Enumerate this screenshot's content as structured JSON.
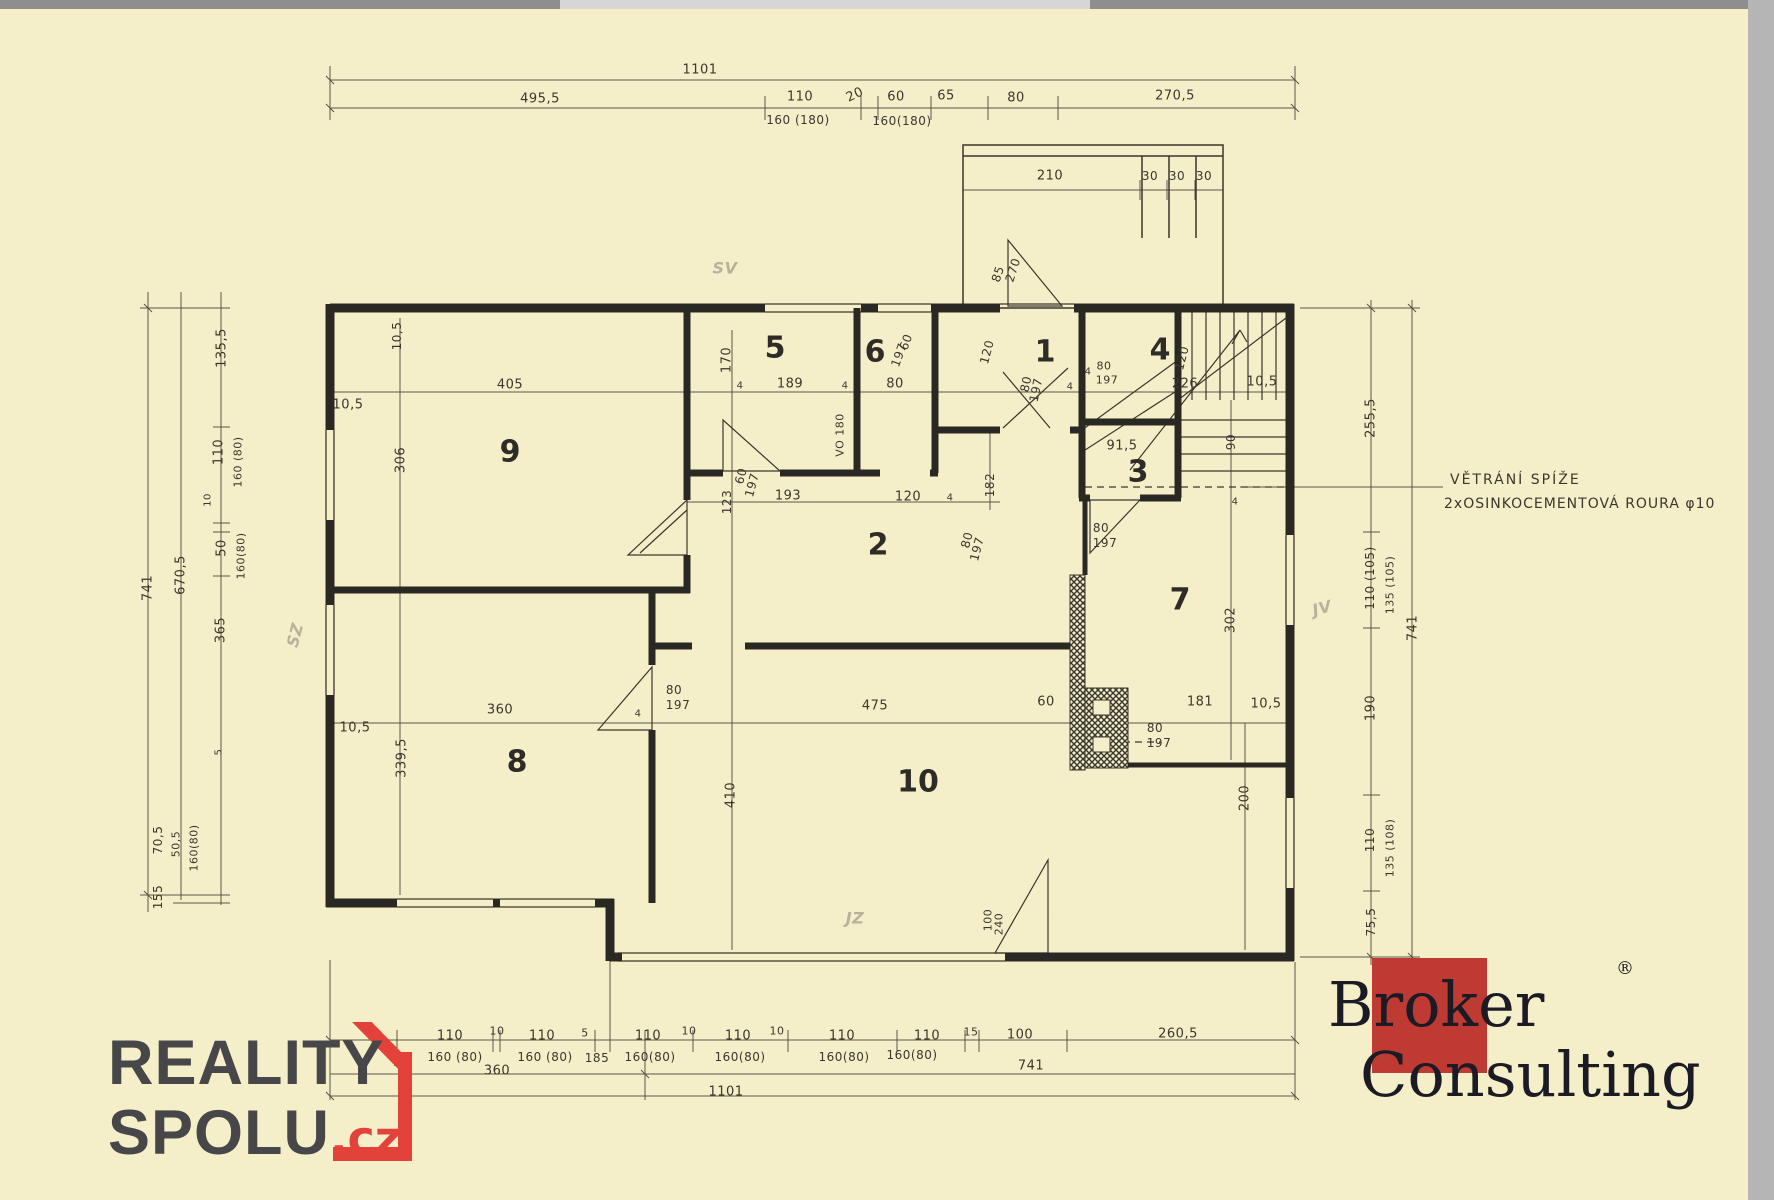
{
  "colors": {
    "paper": "#f5efc9",
    "ink": "#3a372e",
    "wall": "#2a2823",
    "pencil": "#aaa393",
    "reality_red": "#e2423a",
    "reality_grey": "#47474a",
    "broker_red": "#bf3a33",
    "broker_text": "#1b1b25"
  },
  "annotation": {
    "line1": "VĚTRÁNÍ SPÍŽE",
    "line2": "2xOSINKOCEMENTOVÁ ROURA φ10"
  },
  "logos": {
    "reality": {
      "line1": "REALITY",
      "line2": "SPOLU",
      "tld": ".cz"
    },
    "broker": {
      "word1": "Broker",
      "word2": "Consulting",
      "reg": "®"
    }
  },
  "rooms": [
    {
      "n": "1",
      "x": 1045,
      "y": 352
    },
    {
      "n": "2",
      "x": 878,
      "y": 545
    },
    {
      "n": "3",
      "x": 1138,
      "y": 472
    },
    {
      "n": "4",
      "x": 1160,
      "y": 350
    },
    {
      "n": "5",
      "x": 775,
      "y": 348
    },
    {
      "n": "6",
      "x": 875,
      "y": 352
    },
    {
      "n": "7",
      "x": 1180,
      "y": 600
    },
    {
      "n": "8",
      "x": 517,
      "y": 762
    },
    {
      "n": "9",
      "x": 510,
      "y": 452
    },
    {
      "n": "10",
      "x": 918,
      "y": 782
    }
  ],
  "labels": [
    {
      "t": "1101",
      "x": 700,
      "y": 70
    },
    {
      "t": "495,5",
      "x": 540,
      "y": 99
    },
    {
      "t": "110",
      "x": 800,
      "y": 97
    },
    {
      "t": "160 (180)",
      "x": 798,
      "y": 120,
      "s": 12
    },
    {
      "t": "20",
      "x": 855,
      "y": 95,
      "r": -25
    },
    {
      "t": "60",
      "x": 896,
      "y": 97
    },
    {
      "t": "160(180)",
      "x": 902,
      "y": 121,
      "s": 12
    },
    {
      "t": "65",
      "x": 946,
      "y": 96
    },
    {
      "t": "80",
      "x": 1016,
      "y": 98
    },
    {
      "t": "270,5",
      "x": 1175,
      "y": 96
    },
    {
      "t": "210",
      "x": 1050,
      "y": 176
    },
    {
      "t": "30",
      "x": 1150,
      "y": 176,
      "s": 12
    },
    {
      "t": "30",
      "x": 1177,
      "y": 176,
      "s": 12
    },
    {
      "t": "30",
      "x": 1204,
      "y": 176,
      "s": 12
    },
    {
      "t": "SV",
      "x": 725,
      "y": 268,
      "s": 16,
      "c": "pencil"
    },
    {
      "t": "SZ",
      "x": 295,
      "y": 635,
      "r": -75,
      "s": 16,
      "c": "pencil"
    },
    {
      "t": "JV",
      "x": 1322,
      "y": 608,
      "r": -15,
      "s": 16,
      "c": "pencil"
    },
    {
      "t": "JZ",
      "x": 855,
      "y": 918,
      "s": 16,
      "c": "pencil"
    },
    {
      "t": "85",
      "x": 998,
      "y": 274,
      "r": -72,
      "s": 12
    },
    {
      "t": "270",
      "x": 1013,
      "y": 270,
      "r": -72,
      "s": 12
    },
    {
      "t": "405",
      "x": 510,
      "y": 385
    },
    {
      "t": "10,5",
      "x": 348,
      "y": 405
    },
    {
      "t": "10,5",
      "x": 397,
      "y": 336,
      "r": -90,
      "s": 12
    },
    {
      "t": "306",
      "x": 401,
      "y": 460,
      "r": -90
    },
    {
      "t": "4",
      "x": 740,
      "y": 386,
      "s": 10
    },
    {
      "t": "189",
      "x": 790,
      "y": 384
    },
    {
      "t": "80",
      "x": 895,
      "y": 384
    },
    {
      "t": "4",
      "x": 845,
      "y": 386,
      "s": 10
    },
    {
      "t": "120",
      "x": 987,
      "y": 352,
      "r": -75,
      "s": 12
    },
    {
      "t": "80",
      "x": 1026,
      "y": 384,
      "r": -78,
      "s": 12
    },
    {
      "t": "197",
      "x": 1036,
      "y": 390,
      "r": -78,
      "s": 12
    },
    {
      "t": "4",
      "x": 1070,
      "y": 387,
      "s": 10
    },
    {
      "t": "4",
      "x": 1088,
      "y": 372,
      "s": 10
    },
    {
      "t": "80",
      "x": 1104,
      "y": 366,
      "s": 11
    },
    {
      "t": "197",
      "x": 1107,
      "y": 380,
      "s": 11
    },
    {
      "t": "226",
      "x": 1185,
      "y": 384
    },
    {
      "t": "10,5",
      "x": 1262,
      "y": 382
    },
    {
      "t": "120",
      "x": 1182,
      "y": 358,
      "r": -75,
      "s": 12
    },
    {
      "t": "170",
      "x": 727,
      "y": 360,
      "r": -90
    },
    {
      "t": "60",
      "x": 906,
      "y": 342,
      "r": -70,
      "s": 12
    },
    {
      "t": "197",
      "x": 899,
      "y": 355,
      "r": -70,
      "s": 12
    },
    {
      "t": "VO 180",
      "x": 840,
      "y": 435,
      "r": -90,
      "s": 11
    },
    {
      "t": "135,5",
      "x": 222,
      "y": 348,
      "r": -90
    },
    {
      "t": "110",
      "x": 219,
      "y": 452,
      "r": -90
    },
    {
      "t": "160 (80)",
      "x": 238,
      "y": 462,
      "r": -90,
      "s": 11
    },
    {
      "t": "10",
      "x": 208,
      "y": 500,
      "r": -90,
      "s": 10
    },
    {
      "t": "50",
      "x": 222,
      "y": 548,
      "r": -90
    },
    {
      "t": "160(80)",
      "x": 241,
      "y": 556,
      "r": -90,
      "s": 11
    },
    {
      "t": "670,5",
      "x": 181,
      "y": 575,
      "r": -90
    },
    {
      "t": "741",
      "x": 148,
      "y": 588,
      "r": -90
    },
    {
      "t": "365",
      "x": 221,
      "y": 630,
      "r": -90
    },
    {
      "t": "5",
      "x": 219,
      "y": 752,
      "r": -90,
      "s": 10
    },
    {
      "t": "70,5",
      "x": 158,
      "y": 840,
      "r": -90,
      "s": 12
    },
    {
      "t": "50,5",
      "x": 176,
      "y": 844,
      "r": -90,
      "s": 11
    },
    {
      "t": "160(80)",
      "x": 194,
      "y": 848,
      "r": -90,
      "s": 11
    },
    {
      "t": "155",
      "x": 158,
      "y": 897,
      "r": -90,
      "s": 12
    },
    {
      "t": "123",
      "x": 727,
      "y": 502,
      "r": -90,
      "s": 12
    },
    {
      "t": "60",
      "x": 741,
      "y": 476,
      "r": -75,
      "s": 12
    },
    {
      "t": "197",
      "x": 752,
      "y": 485,
      "r": -75,
      "s": 12
    },
    {
      "t": "193",
      "x": 788,
      "y": 496
    },
    {
      "t": "120",
      "x": 908,
      "y": 497
    },
    {
      "t": "4",
      "x": 950,
      "y": 498,
      "s": 10
    },
    {
      "t": "182",
      "x": 990,
      "y": 485,
      "r": -90,
      "s": 12
    },
    {
      "t": "80",
      "x": 967,
      "y": 540,
      "r": -75,
      "s": 12
    },
    {
      "t": "197",
      "x": 977,
      "y": 549,
      "r": -75,
      "s": 12
    },
    {
      "t": "91,5",
      "x": 1122,
      "y": 446
    },
    {
      "t": "90",
      "x": 1231,
      "y": 442,
      "r": -90,
      "s": 12
    },
    {
      "t": "4",
      "x": 1235,
      "y": 502,
      "s": 10
    },
    {
      "t": "80",
      "x": 1101,
      "y": 528,
      "s": 12
    },
    {
      "t": "197",
      "x": 1105,
      "y": 543,
      "s": 12
    },
    {
      "t": "10,5",
      "x": 355,
      "y": 728
    },
    {
      "t": "360",
      "x": 500,
      "y": 710
    },
    {
      "t": "339,5",
      "x": 402,
      "y": 758,
      "r": -90
    },
    {
      "t": "4",
      "x": 638,
      "y": 714,
      "s": 10
    },
    {
      "t": "80",
      "x": 674,
      "y": 690,
      "s": 12
    },
    {
      "t": "197",
      "x": 678,
      "y": 705,
      "s": 12
    },
    {
      "t": "475",
      "x": 875,
      "y": 706
    },
    {
      "t": "60",
      "x": 1046,
      "y": 702
    },
    {
      "t": "181",
      "x": 1200,
      "y": 702
    },
    {
      "t": "10,5",
      "x": 1266,
      "y": 704
    },
    {
      "t": "80",
      "x": 1155,
      "y": 728,
      "s": 12
    },
    {
      "t": "197",
      "x": 1159,
      "y": 743,
      "s": 12
    },
    {
      "t": "302",
      "x": 1231,
      "y": 620,
      "r": -90
    },
    {
      "t": "200",
      "x": 1245,
      "y": 798,
      "r": -90
    },
    {
      "t": "410",
      "x": 731,
      "y": 795,
      "r": -90
    },
    {
      "t": "100",
      "x": 988,
      "y": 920,
      "r": -90,
      "s": 11
    },
    {
      "t": "240",
      "x": 999,
      "y": 924,
      "r": -90,
      "s": 11
    },
    {
      "t": "255,5",
      "x": 1371,
      "y": 418,
      "r": -90
    },
    {
      "t": "110 (105)",
      "x": 1370,
      "y": 578,
      "r": -90,
      "s": 12
    },
    {
      "t": "135 (105)",
      "x": 1390,
      "y": 585,
      "r": -90,
      "s": 11
    },
    {
      "t": "190",
      "x": 1371,
      "y": 708,
      "r": -90
    },
    {
      "t": "110",
      "x": 1370,
      "y": 840,
      "r": -90,
      "s": 12
    },
    {
      "t": "135 (108)",
      "x": 1390,
      "y": 848,
      "r": -90,
      "s": 11
    },
    {
      "t": "75,5",
      "x": 1371,
      "y": 922,
      "r": -90,
      "s": 12
    },
    {
      "t": "741",
      "x": 1413,
      "y": 628,
      "r": -90
    },
    {
      "t": "110",
      "x": 450,
      "y": 1036
    },
    {
      "t": "160 (80)",
      "x": 455,
      "y": 1057,
      "s": 12
    },
    {
      "t": "10",
      "x": 497,
      "y": 1031,
      "s": 11
    },
    {
      "t": "110",
      "x": 542,
      "y": 1036
    },
    {
      "t": "160 (80)",
      "x": 545,
      "y": 1057,
      "s": 12
    },
    {
      "t": "5",
      "x": 585,
      "y": 1033,
      "s": 11
    },
    {
      "t": "185",
      "x": 597,
      "y": 1058,
      "s": 12
    },
    {
      "t": "110",
      "x": 648,
      "y": 1036
    },
    {
      "t": "160(80)",
      "x": 650,
      "y": 1057,
      "s": 12
    },
    {
      "t": "10",
      "x": 689,
      "y": 1031,
      "s": 11
    },
    {
      "t": "110",
      "x": 738,
      "y": 1036
    },
    {
      "t": "160(80)",
      "x": 740,
      "y": 1057,
      "s": 12
    },
    {
      "t": "10",
      "x": 777,
      "y": 1031,
      "s": 11
    },
    {
      "t": "110",
      "x": 842,
      "y": 1036
    },
    {
      "t": "160(80)",
      "x": 844,
      "y": 1057,
      "s": 12
    },
    {
      "t": "110",
      "x": 927,
      "y": 1036
    },
    {
      "t": "160(80)",
      "x": 912,
      "y": 1055,
      "s": 12
    },
    {
      "t": "15",
      "x": 971,
      "y": 1032,
      "s": 11
    },
    {
      "t": "100",
      "x": 1020,
      "y": 1035
    },
    {
      "t": "260,5",
      "x": 1178,
      "y": 1034
    },
    {
      "t": "360",
      "x": 497,
      "y": 1071
    },
    {
      "t": "741",
      "x": 1031,
      "y": 1066
    },
    {
      "t": "1101",
      "x": 726,
      "y": 1092
    }
  ]
}
